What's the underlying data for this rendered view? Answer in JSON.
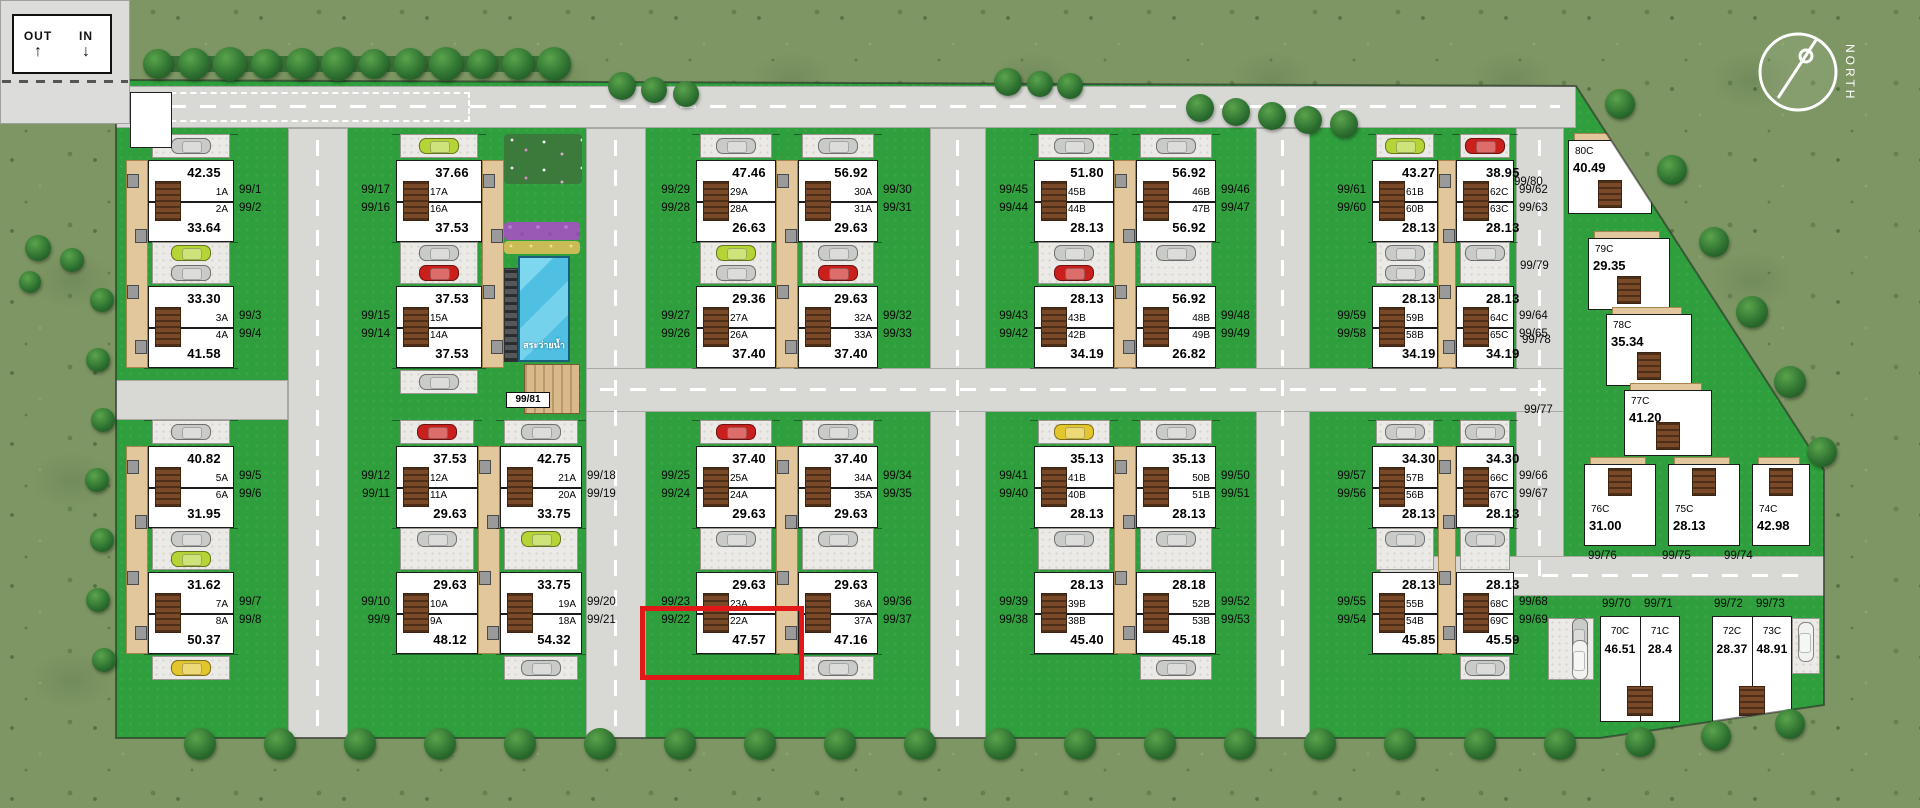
{
  "entrance": {
    "out_label": "OUT",
    "in_label": "IN",
    "out_arrow": "↑",
    "in_arrow": "↓"
  },
  "compass": {
    "label": "NORTH"
  },
  "amenities": {
    "pool_label": "สระว่ายน้ำ",
    "clubhouse_lot": "99/81"
  },
  "highlight": {
    "lot": "99/22",
    "color": "#e21818"
  },
  "palette": {
    "lawn": "#2f9e3c",
    "field": "#7d9663",
    "road": "#d8d8d5",
    "house": "#ffffff",
    "stair": "#7a4a28",
    "walkway_tan": "#e2c79d",
    "pool_blue": "#4fbfe2",
    "tree": "#2d7030",
    "highlight_red": "#e21818",
    "car_silver": "#c9cbc8",
    "car_lime": "#b5d435",
    "car_red": "#c9201d",
    "car_yellow": "#e3c52c",
    "car_white": "#f2f2f0"
  },
  "clusters": {
    "a1": {
      "units": [
        {
          "lot": "99/1",
          "code": "1A",
          "area": "42.35"
        },
        {
          "lot": "99/2",
          "code": "2A",
          "area": "33.64"
        },
        {
          "lot": "99/3",
          "code": "3A",
          "area": "33.30"
        },
        {
          "lot": "99/4",
          "code": "4A",
          "area": "41.58"
        }
      ]
    },
    "a2": {
      "units": [
        {
          "lot": "99/5",
          "code": "5A",
          "area": "40.82"
        },
        {
          "lot": "99/6",
          "code": "6A",
          "area": "31.95"
        },
        {
          "lot": "99/7",
          "code": "7A",
          "area": "31.62"
        },
        {
          "lot": "99/8",
          "code": "8A",
          "area": "50.37"
        }
      ]
    },
    "b1": {
      "units": [
        {
          "lot": "99/17",
          "code": "17A",
          "area": "37.66"
        },
        {
          "lot": "99/16",
          "code": "16A",
          "area": "37.53"
        },
        {
          "lot": "99/15",
          "code": "15A",
          "area": "37.53"
        },
        {
          "lot": "99/14",
          "code": "14A",
          "area": "37.53"
        }
      ]
    },
    "b2l": {
      "units": [
        {
          "lot": "99/12",
          "code": "12A",
          "area": "37.53"
        },
        {
          "lot": "99/11",
          "code": "11A",
          "area": "29.63"
        },
        {
          "lot": "99/10",
          "code": "10A",
          "area": "29.63"
        },
        {
          "lot": "99/9",
          "code": "9A",
          "area": "48.12"
        }
      ]
    },
    "b2r": {
      "units": [
        {
          "lot": "99/18",
          "code": "21A",
          "area": "42.75"
        },
        {
          "lot": "99/19",
          "code": "20A",
          "area": "33.75"
        },
        {
          "lot": "99/20",
          "code": "19A",
          "area": "33.75"
        },
        {
          "lot": "99/21",
          "code": "18A",
          "area": "54.32"
        }
      ]
    },
    "c1l": {
      "units": [
        {
          "lot": "99/29",
          "code": "29A",
          "area": "47.46"
        },
        {
          "lot": "99/28",
          "code": "28A",
          "area": "26.63"
        },
        {
          "lot": "99/27",
          "code": "27A",
          "area": "29.36"
        },
        {
          "lot": "99/26",
          "code": "26A",
          "area": "37.40"
        }
      ]
    },
    "c1r": {
      "units": [
        {
          "lot": "99/30",
          "code": "30A",
          "area": "56.92"
        },
        {
          "lot": "99/31",
          "code": "31A",
          "area": "29.63"
        },
        {
          "lot": "99/32",
          "code": "32A",
          "area": "29.63"
        },
        {
          "lot": "99/33",
          "code": "33A",
          "area": "37.40"
        }
      ]
    },
    "c2l": {
      "units": [
        {
          "lot": "99/25",
          "code": "25A",
          "area": "37.40"
        },
        {
          "lot": "99/24",
          "code": "24A",
          "area": "29.63"
        },
        {
          "lot": "99/23",
          "code": "23A",
          "area": "29.63"
        },
        {
          "lot": "99/22",
          "code": "22A",
          "area": "47.57"
        }
      ]
    },
    "c2r": {
      "units": [
        {
          "lot": "99/34",
          "code": "34A",
          "area": "37.40"
        },
        {
          "lot": "99/35",
          "code": "35A",
          "area": "29.63"
        },
        {
          "lot": "99/36",
          "code": "36A",
          "area": "29.63"
        },
        {
          "lot": "99/37",
          "code": "37A",
          "area": "47.16"
        }
      ]
    },
    "d1l": {
      "units": [
        {
          "lot": "99/45",
          "code": "45B",
          "area": "51.80"
        },
        {
          "lot": "99/44",
          "code": "44B",
          "area": "28.13"
        },
        {
          "lot": "99/43",
          "code": "43B",
          "area": "28.13"
        },
        {
          "lot": "99/42",
          "code": "42B",
          "area": "34.19"
        }
      ]
    },
    "d1r": {
      "units": [
        {
          "lot": "99/46",
          "code": "46B",
          "area": "56.92"
        },
        {
          "lot": "99/47",
          "code": "47B",
          "area": "56.92"
        },
        {
          "lot": "99/48",
          "code": "48B",
          "area": "56.92"
        },
        {
          "lot": "99/49",
          "code": "49B",
          "area": "26.82"
        }
      ]
    },
    "d2l": {
      "units": [
        {
          "lot": "99/41",
          "code": "41B",
          "area": "35.13"
        },
        {
          "lot": "99/40",
          "code": "40B",
          "area": "28.13"
        },
        {
          "lot": "99/39",
          "code": "39B",
          "area": "28.13"
        },
        {
          "lot": "99/38",
          "code": "38B",
          "area": "45.40"
        }
      ]
    },
    "d2r": {
      "units": [
        {
          "lot": "99/50",
          "code": "50B",
          "area": "35.13"
        },
        {
          "lot": "99/51",
          "code": "51B",
          "area": "28.13"
        },
        {
          "lot": "99/52",
          "code": "52B",
          "area": "28.18"
        },
        {
          "lot": "99/53",
          "code": "53B",
          "area": "45.18"
        }
      ]
    },
    "e1l": {
      "units": [
        {
          "lot": "99/61",
          "code": "61B",
          "area": "43.27"
        },
        {
          "lot": "99/60",
          "code": "60B",
          "area": "28.13"
        },
        {
          "lot": "99/59",
          "code": "59B",
          "area": "28.13"
        },
        {
          "lot": "99/58",
          "code": "58B",
          "area": "34.19"
        }
      ]
    },
    "e1r": {
      "units": [
        {
          "lot": "99/62",
          "code": "62C",
          "area": "38.95"
        },
        {
          "lot": "99/63",
          "code": "63C",
          "area": "28.13"
        },
        {
          "lot": "99/64",
          "code": "64C",
          "area": "28.13"
        },
        {
          "lot": "99/65",
          "code": "65C",
          "area": "34.19"
        }
      ]
    },
    "e2l": {
      "units": [
        {
          "lot": "99/57",
          "code": "57B",
          "area": "34.30"
        },
        {
          "lot": "99/56",
          "code": "56B",
          "area": "28.13"
        },
        {
          "lot": "99/55",
          "code": "55B",
          "area": "28.13"
        },
        {
          "lot": "99/54",
          "code": "54B",
          "area": "45.85"
        }
      ]
    },
    "e2r": {
      "units": [
        {
          "lot": "99/66",
          "code": "66C",
          "area": "34.30"
        },
        {
          "lot": "99/67",
          "code": "67C",
          "area": "28.13"
        },
        {
          "lot": "99/68",
          "code": "68C",
          "area": "28.13"
        },
        {
          "lot": "99/69",
          "code": "69C",
          "area": "45.59"
        }
      ]
    }
  },
  "edge_units": [
    {
      "lot": "99/80",
      "code": "80C",
      "area": "40.49"
    },
    {
      "lot": "99/79",
      "code": "79C",
      "area": "29.35"
    },
    {
      "lot": "99/78",
      "code": "78C",
      "area": "35.34"
    },
    {
      "lot": "99/77",
      "code": "77C",
      "area": "41.20"
    },
    {
      "lot": "99/76",
      "code": "76C",
      "area": "31.00"
    },
    {
      "lot": "99/75",
      "code": "75C",
      "area": "28.13"
    },
    {
      "lot": "99/74",
      "code": "74C",
      "area": "42.98"
    }
  ],
  "row_houses": {
    "lots": [
      "99/70",
      "99/71",
      "99/72",
      "99/73"
    ],
    "units": [
      {
        "code": "70C",
        "area": "46.51"
      },
      {
        "code": "71C",
        "area": "28.4"
      },
      {
        "code": "72C",
        "area": "28.37"
      },
      {
        "code": "73C",
        "area": "48.91"
      }
    ]
  }
}
